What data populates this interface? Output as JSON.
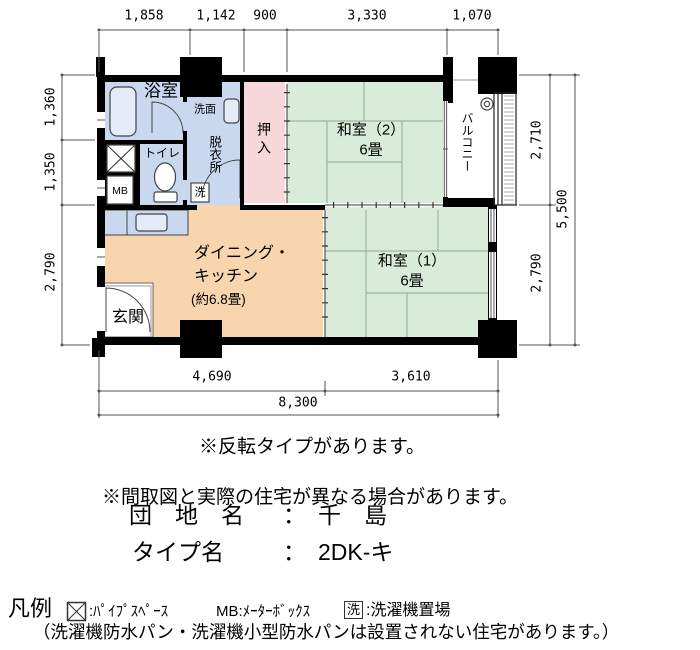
{
  "plan": {
    "dims": {
      "top": [
        "1,858",
        "1,142",
        "900",
        "3,330",
        "1,070"
      ],
      "left": [
        "1,360",
        "1,350",
        "2,790"
      ],
      "right": [
        "2,710",
        "2,790"
      ],
      "right_total": "5,500",
      "bottom": [
        "4,690",
        "3,610"
      ],
      "bottom_total": "8,300"
    },
    "rooms": {
      "bath": "浴室",
      "washbasin": "洗面",
      "dressing": "脱衣所",
      "toilet": "トイレ",
      "meter_box": "MB",
      "washer": "洗",
      "closet": "押入",
      "washitsu2": "和室（2）",
      "washitsu2_size": "6畳",
      "balcony": "バルコニー",
      "dk_line1": "ダイニング・",
      "dk_line2": "キッチン",
      "dk_line3": "(約6.8畳)",
      "genkan": "玄関",
      "washitsu1": "和室（1）",
      "washitsu1_size": "6畳"
    }
  },
  "notes": {
    "flip": "※反転タイプがあります。",
    "difference": "※間取図と実際の住宅が異なる場合があります。"
  },
  "estate": {
    "name_label": "団　地　名",
    "colon": "：",
    "name_value": "千　島",
    "type_label": "タイプ名",
    "type_value": "2DK-キ"
  },
  "legend": {
    "title": "凡例",
    "ps_label": ":ﾊﾟｲﾌﾟｽﾍﾟｰｽ",
    "mb_label": "MB:ﾒｰﾀｰﾎﾞｯｸｽ",
    "washer_symbol": "洗",
    "washer_label": ":洗濯機置場",
    "note": "（洗濯機防水パン・洗濯機小型防水パンは設置されない住宅があります。）"
  },
  "colors": {
    "wall": "#000000",
    "blue": "#c9d8ee",
    "fixture": "#e3ebf8",
    "pink": "#f6d7da",
    "green": "#d9ecd9",
    "peach": "#f8d5ad",
    "tatami_line": "#9db79b",
    "dim_line": "#555555"
  }
}
